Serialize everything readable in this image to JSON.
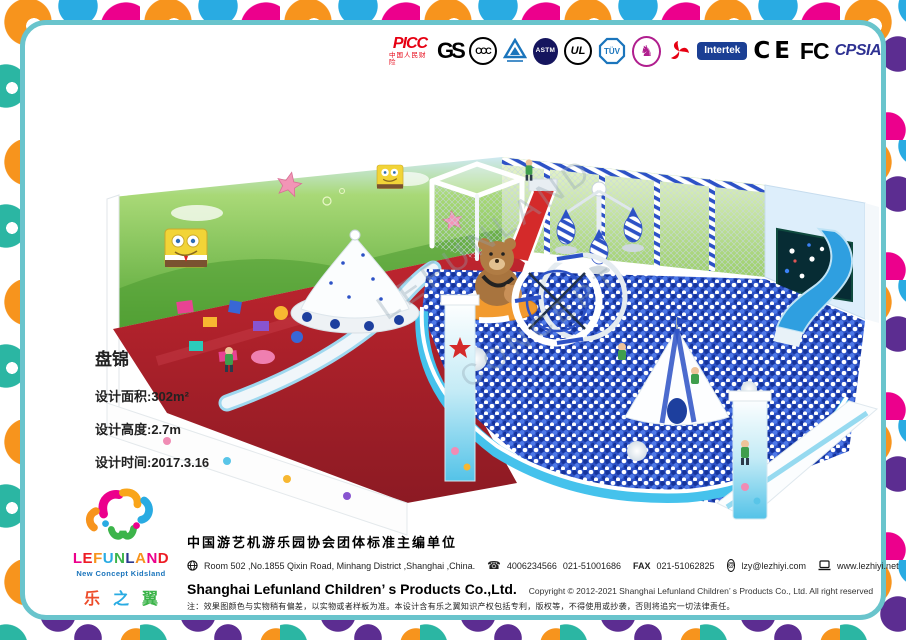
{
  "frame": {
    "border_color": "#69c4cc",
    "pattern_colors": [
      "#f7941d",
      "#ec008c",
      "#5c2d91",
      "#29abe2",
      "#2bb6a3"
    ]
  },
  "certifications": {
    "picc": {
      "label": "PICC",
      "sub": "中国人民财险",
      "color": "#e60012"
    },
    "gs": {
      "label": "GS"
    },
    "ccc": {
      "label": "CCC"
    },
    "astm": {
      "label": "ASTM"
    },
    "ul": {
      "label": "UL"
    },
    "tuv": {
      "label": "TÜV"
    },
    "intertek": {
      "label": "Intertek"
    },
    "ce": {
      "label": "CE"
    },
    "fcc": {
      "label": "FC"
    },
    "cpsia": {
      "label": "CPSIA",
      "color": "#2e3192"
    }
  },
  "project": {
    "title": "盘锦",
    "line_area": "设计面积:302m²",
    "line_height": "设计高度:2.7m",
    "line_date": "设计时间:2017.3.16"
  },
  "brand": {
    "letters": [
      {
        "ch": "L",
        "color": "#ec008c"
      },
      {
        "ch": "E",
        "color": "#ed1c24"
      },
      {
        "ch": "F",
        "color": "#f7941d"
      },
      {
        "ch": "U",
        "color": "#29abe2"
      },
      {
        "ch": "N",
        "color": "#3cb44a"
      },
      {
        "ch": "L",
        "color": "#2b3990"
      },
      {
        "ch": "A",
        "color": "#f7941d"
      },
      {
        "ch": "N",
        "color": "#ec008c"
      },
      {
        "ch": "D",
        "color": "#ed1c24"
      }
    ],
    "tagline": "New Concept Kidsland",
    "cn": [
      {
        "ch": "乐",
        "color": "#ed4c2a"
      },
      {
        "ch": "之",
        "color": "#29abe2"
      },
      {
        "ch": "翼",
        "color": "#3cb44a"
      }
    ]
  },
  "footer": {
    "org": "中国游艺机游乐园协会团体标准主编单位",
    "address": "Room 502 ,No.1855 Qixin Road, Minhang District ,Shanghai ,China.",
    "phone1": "4006234566",
    "phone2": "021-51001686",
    "fax_label": "FAX",
    "fax": "021-51062825",
    "email": "lzy@lezhiyi.com",
    "website": "www.lezhiyi.net",
    "company": "Shanghai Lefunland Children’ s Products Co.,Ltd.",
    "copyright": "Copyright © 2012-2021 Shanghai Lefunland Children’ s Products Co., Ltd. All right reserved",
    "disclaimer": "注：效果图颜色与实物稍有偏差，以实物或者样板为准。本设计含有乐之翼知识产权包括专利，版权等，不得使用或抄袭，否则将追究一切法律责任。"
  },
  "artwork": {
    "watermark_line1": "LEFUNLAND",
    "watermark_line2": "CONCEPT"
  }
}
